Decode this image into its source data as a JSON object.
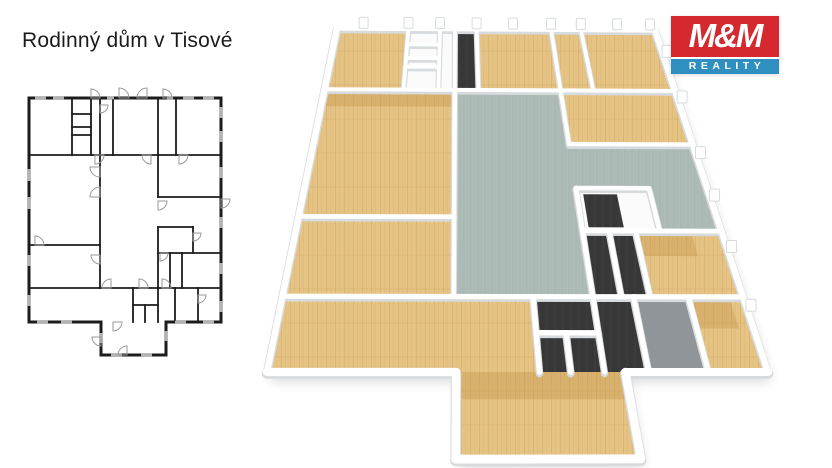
{
  "title": "Rodinný dům v Tisové",
  "logo": {
    "mm": "M&M",
    "reality": "REALITY",
    "red": "#d6292f",
    "blue": "#2e8fc0"
  },
  "colors": {
    "line": "#1c1c1c",
    "window": "#b3b3b3",
    "door": "#9a9a9a",
    "wood": "#e4c384",
    "wood_streak1": "#d2a75e",
    "wood_streak2": "#dcb66e",
    "wood_row": "#c9a055",
    "patch": "#c08c42",
    "teal": "#aebcb8",
    "teal_streak1": "#9fafab",
    "teal_streak2": "#a5b5b1",
    "dark": "#373737",
    "dark_line": "#454545",
    "gray": "#8f9598",
    "wall": "#fbfbfc",
    "wall_edge": "#d7dbdd",
    "outer_edge": "#e3e6e8"
  },
  "plan2d": {
    "outer": [
      [
        14,
        13
      ],
      [
        206,
        13
      ],
      [
        206,
        237
      ],
      [
        151,
        237
      ],
      [
        151,
        270
      ],
      [
        86,
        270
      ],
      [
        86,
        237
      ],
      [
        14,
        237
      ]
    ],
    "walls": [
      [
        57,
        13,
        57,
        70
      ],
      [
        76,
        13,
        76,
        70
      ],
      [
        57,
        29,
        76,
        29
      ],
      [
        57,
        42,
        76,
        42
      ],
      [
        57,
        50,
        76,
        50
      ],
      [
        85,
        13,
        85,
        70
      ],
      [
        98,
        13,
        98,
        70
      ],
      [
        143,
        13,
        143,
        70
      ],
      [
        161,
        13,
        161,
        70
      ],
      [
        14,
        70,
        206,
        70
      ],
      [
        85,
        70,
        85,
        203
      ],
      [
        14,
        160,
        85,
        160
      ],
      [
        143,
        70,
        143,
        112
      ],
      [
        143,
        142,
        143,
        237
      ],
      [
        143,
        112,
        206,
        112
      ],
      [
        143,
        142,
        178,
        142
      ],
      [
        178,
        142,
        178,
        168
      ],
      [
        143,
        168,
        206,
        168
      ],
      [
        155,
        168,
        155,
        203
      ],
      [
        167,
        168,
        167,
        203
      ],
      [
        14,
        203,
        143,
        203
      ],
      [
        143,
        203,
        206,
        203
      ],
      [
        118,
        203,
        118,
        237
      ],
      [
        118,
        220,
        143,
        220
      ],
      [
        130,
        220,
        130,
        237
      ],
      [
        160,
        203,
        160,
        237
      ],
      [
        183,
        203,
        183,
        237
      ]
    ],
    "doors": [
      {
        "x": 76,
        "y": 13,
        "a": 270,
        "r": 9
      },
      {
        "x": 104,
        "y": 13,
        "a": 270,
        "r": 10
      },
      {
        "x": 132,
        "y": 13,
        "a": 180,
        "r": 10
      },
      {
        "x": 148,
        "y": 13,
        "a": 270,
        "r": 9
      },
      {
        "x": 85,
        "y": 20,
        "a": 0,
        "r": 8
      },
      {
        "x": 80,
        "y": 70,
        "a": 0,
        "r": 9
      },
      {
        "x": 136,
        "y": 70,
        "a": 90,
        "r": 9
      },
      {
        "x": 164,
        "y": 70,
        "a": 0,
        "r": 9
      },
      {
        "x": 85,
        "y": 82,
        "a": 90,
        "r": 10
      },
      {
        "x": 85,
        "y": 112,
        "a": 180,
        "r": 10
      },
      {
        "x": 20,
        "y": 160,
        "a": 270,
        "r": 9
      },
      {
        "x": 85,
        "y": 170,
        "a": 90,
        "r": 9
      },
      {
        "x": 143,
        "y": 116,
        "a": 0,
        "r": 9
      },
      {
        "x": 206,
        "y": 114,
        "a": 0,
        "r": 9
      },
      {
        "x": 178,
        "y": 148,
        "a": 0,
        "r": 8
      },
      {
        "x": 145,
        "y": 168,
        "a": 0,
        "r": 8
      },
      {
        "x": 96,
        "y": 203,
        "a": 180,
        "r": 9
      },
      {
        "x": 124,
        "y": 203,
        "a": 270,
        "r": 9
      },
      {
        "x": 147,
        "y": 203,
        "a": 270,
        "r": 9
      },
      {
        "x": 183,
        "y": 210,
        "a": 0,
        "r": 8
      },
      {
        "x": 98,
        "y": 237,
        "a": 0,
        "r": 9
      },
      {
        "x": 86,
        "y": 252,
        "a": 90,
        "r": 9
      },
      {
        "x": 112,
        "y": 270,
        "a": 180,
        "r": 9
      }
    ],
    "windows": [
      [
        20,
        13,
        31,
        13
      ],
      [
        38,
        13,
        49,
        13
      ],
      [
        92,
        13,
        99,
        13
      ],
      [
        152,
        13,
        158,
        13
      ],
      [
        168,
        13,
        179,
        13
      ],
      [
        188,
        13,
        199,
        13
      ],
      [
        14,
        84,
        14,
        96
      ],
      [
        14,
        112,
        14,
        124
      ],
      [
        14,
        170,
        14,
        181
      ],
      [
        14,
        210,
        14,
        221
      ],
      [
        206,
        22,
        206,
        33
      ],
      [
        206,
        46,
        206,
        57
      ],
      [
        206,
        82,
        206,
        93
      ],
      [
        206,
        132,
        206,
        143
      ],
      [
        206,
        178,
        206,
        189
      ],
      [
        206,
        216,
        206,
        227
      ],
      [
        22,
        237,
        33,
        237
      ],
      [
        46,
        237,
        57,
        237
      ],
      [
        160,
        237,
        171,
        237
      ],
      [
        188,
        237,
        199,
        237
      ],
      [
        86,
        248,
        86,
        258
      ],
      [
        151,
        246,
        151,
        256
      ],
      [
        96,
        270,
        107,
        270
      ],
      [
        126,
        270,
        137,
        270
      ]
    ]
  },
  "plan3d": {
    "corners": {
      "tl": [
        337,
        28
      ],
      "tr": [
        655,
        30
      ],
      "br": [
        768,
        372
      ],
      "bl": [
        267,
        372
      ]
    },
    "rooms": [
      {
        "name": "room-wood",
        "fill": "wood",
        "poly": [
          [
            14,
            13
          ],
          [
            57,
            13
          ],
          [
            57,
            70
          ],
          [
            14,
            70
          ]
        ]
      },
      {
        "name": "closet-cells",
        "fill": "wall",
        "poly": [
          [
            57,
            13
          ],
          [
            85,
            13
          ],
          [
            85,
            70
          ],
          [
            57,
            70
          ]
        ]
      },
      {
        "name": "room-dark-strip",
        "fill": "dark",
        "poly": [
          [
            85,
            13
          ],
          [
            98,
            13
          ],
          [
            98,
            70
          ],
          [
            85,
            70
          ]
        ]
      },
      {
        "name": "room-wood",
        "fill": "wood",
        "poly": [
          [
            98,
            13
          ],
          [
            143,
            13
          ],
          [
            143,
            70
          ],
          [
            98,
            70
          ]
        ]
      },
      {
        "name": "room-wood",
        "fill": "wood",
        "poly": [
          [
            143,
            13
          ],
          [
            161,
            13
          ],
          [
            161,
            70
          ],
          [
            143,
            70
          ]
        ]
      },
      {
        "name": "room-wood",
        "fill": "wood",
        "poly": [
          [
            161,
            13
          ],
          [
            206,
            13
          ],
          [
            206,
            70
          ],
          [
            161,
            70
          ]
        ]
      },
      {
        "name": "room-wood",
        "fill": "wood",
        "poly": [
          [
            14,
            70
          ],
          [
            85,
            70
          ],
          [
            85,
            160
          ],
          [
            14,
            160
          ]
        ]
      },
      {
        "name": "room-wood",
        "fill": "wood",
        "poly": [
          [
            14,
            160
          ],
          [
            85,
            160
          ],
          [
            85,
            203
          ],
          [
            14,
            203
          ]
        ]
      },
      {
        "name": "hall-teal",
        "fill": "teal",
        "poly": [
          [
            85,
            70
          ],
          [
            143,
            70
          ],
          [
            143,
            112
          ],
          [
            206,
            112
          ],
          [
            206,
            168
          ],
          [
            178,
            168
          ],
          [
            178,
            142
          ],
          [
            143,
            142
          ],
          [
            143,
            203
          ],
          [
            85,
            203
          ]
        ]
      },
      {
        "name": "room-wood",
        "fill": "wood",
        "poly": [
          [
            143,
            70
          ],
          [
            180,
            70
          ],
          [
            180,
            112
          ],
          [
            143,
            112
          ]
        ]
      },
      {
        "name": "room-wood",
        "fill": "wood",
        "poly": [
          [
            180,
            70
          ],
          [
            206,
            70
          ],
          [
            206,
            112
          ],
          [
            180,
            112
          ]
        ]
      },
      {
        "name": "room-wall",
        "fill": "wall",
        "poly": [
          [
            143,
            142
          ],
          [
            178,
            142
          ],
          [
            178,
            168
          ],
          [
            143,
            168
          ]
        ]
      },
      {
        "name": "closet-dark",
        "fill": "dark",
        "poly": [
          [
            146,
            146
          ],
          [
            162,
            146
          ],
          [
            162,
            166
          ],
          [
            146,
            166
          ]
        ]
      },
      {
        "name": "cell-dark",
        "fill": "dark",
        "poly": [
          [
            143,
            168
          ],
          [
            155,
            168
          ],
          [
            155,
            203
          ],
          [
            143,
            203
          ]
        ]
      },
      {
        "name": "cell-dark",
        "fill": "dark",
        "poly": [
          [
            155,
            168
          ],
          [
            167,
            168
          ],
          [
            167,
            203
          ],
          [
            155,
            203
          ]
        ]
      },
      {
        "name": "room-wood",
        "fill": "wood",
        "poly": [
          [
            167,
            168
          ],
          [
            206,
            168
          ],
          [
            206,
            203
          ],
          [
            167,
            203
          ]
        ]
      },
      {
        "name": "room-wood",
        "fill": "wood",
        "poly": [
          [
            14,
            203
          ],
          [
            85,
            203
          ],
          [
            85,
            237
          ],
          [
            14,
            237
          ]
        ]
      },
      {
        "name": "room-wood",
        "fill": "wood",
        "poly": [
          [
            85,
            203
          ],
          [
            118,
            203
          ],
          [
            118,
            237
          ],
          [
            85,
            237
          ]
        ]
      },
      {
        "name": "room-dark",
        "fill": "dark",
        "poly": [
          [
            118,
            203
          ],
          [
            143,
            203
          ],
          [
            143,
            237
          ],
          [
            118,
            237
          ]
        ]
      },
      {
        "name": "room-dark",
        "fill": "dark",
        "poly": [
          [
            143,
            203
          ],
          [
            160,
            203
          ],
          [
            160,
            237
          ],
          [
            143,
            237
          ]
        ]
      },
      {
        "name": "room-gray",
        "fill": "gray",
        "poly": [
          [
            160,
            203
          ],
          [
            183,
            203
          ],
          [
            183,
            237
          ],
          [
            160,
            237
          ]
        ]
      },
      {
        "name": "room-wood",
        "fill": "wood",
        "poly": [
          [
            183,
            203
          ],
          [
            206,
            203
          ],
          [
            206,
            237
          ],
          [
            183,
            237
          ]
        ]
      },
      {
        "name": "room-wood-extension",
        "fill": "wood",
        "poly": [
          [
            86,
            237
          ],
          [
            151,
            237
          ],
          [
            151,
            270
          ],
          [
            86,
            270
          ]
        ]
      },
      {
        "name": "wood-patch",
        "fill": "patch",
        "poly": [
          [
            167,
            168
          ],
          [
            192,
            168
          ],
          [
            192,
            182
          ],
          [
            167,
            182
          ]
        ]
      },
      {
        "name": "wood-patch",
        "fill": "patch",
        "poly": [
          [
            183,
            203
          ],
          [
            200,
            203
          ],
          [
            200,
            218
          ],
          [
            183,
            218
          ]
        ]
      },
      {
        "name": "wood-patch",
        "fill": "patch",
        "poly": [
          [
            88,
            237
          ],
          [
            151,
            237
          ],
          [
            151,
            248
          ],
          [
            88,
            248
          ]
        ]
      },
      {
        "name": "wood-patch",
        "fill": "patch",
        "poly": [
          [
            14,
            70
          ],
          [
            85,
            70
          ],
          [
            85,
            84
          ],
          [
            14,
            84
          ]
        ]
      }
    ],
    "caps_top": [
      30,
      57,
      76,
      98,
      120,
      143,
      161,
      183,
      203
    ],
    "caps_right": [
      40,
      80,
      122,
      150,
      180,
      210
    ]
  }
}
